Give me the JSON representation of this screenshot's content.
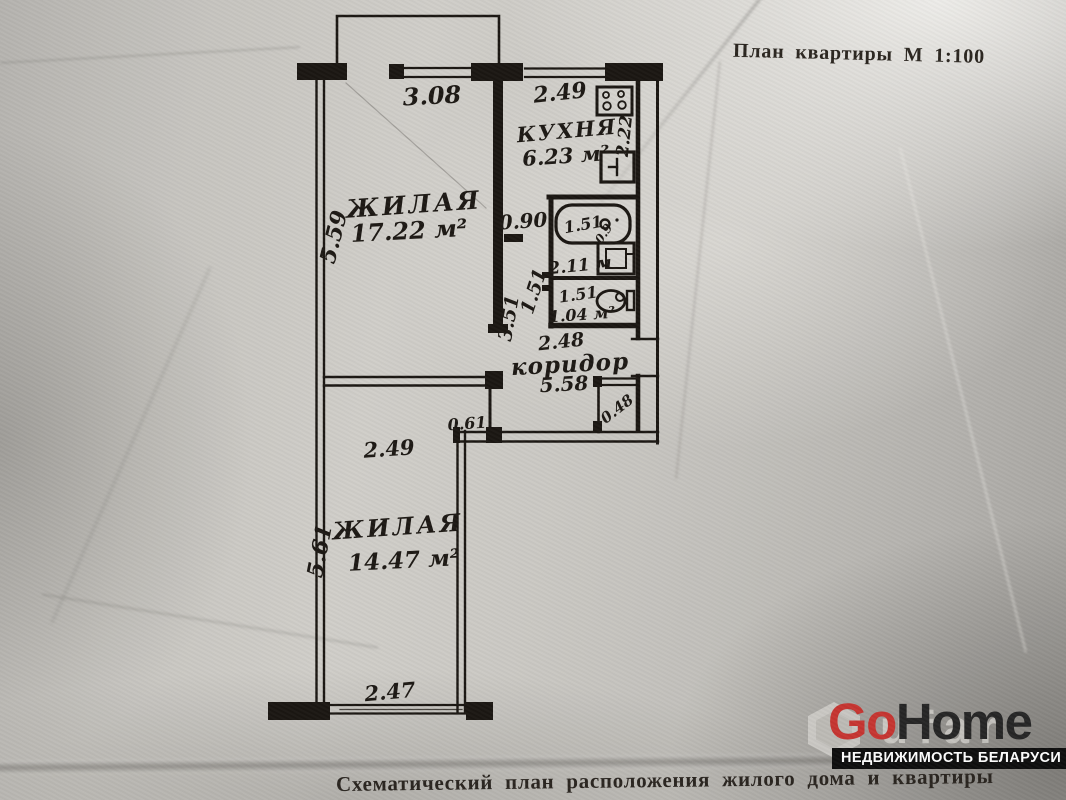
{
  "page": {
    "title": "План квартиры М 1:100",
    "caption": "Схематический план расположения жилого дома и квартиры"
  },
  "branding": {
    "logo_go": "Go",
    "logo_home": "Home",
    "tagline": "НЕДВИЖИМОСТЬ БЕЛАРУСИ",
    "watermark_ghost": "ufar",
    "logo_red": "#c63531",
    "logo_dark": "#262626"
  },
  "colors": {
    "paper": "#c6c4bf",
    "ink": "#1b1712"
  },
  "plan": {
    "rooms": {
      "living1": {
        "name": "ЖИЛАЯ",
        "area": "17.22 м²"
      },
      "kitchen": {
        "name": "КУХНЯ",
        "area": "6.23 м²"
      },
      "bathroom": {
        "area": "2.11 м"
      },
      "wc": {
        "area": "1.04 м²"
      },
      "corridor": {
        "name": "коридор",
        "area": "5.58"
      },
      "living2": {
        "name": "ЖИЛАЯ",
        "area": "14.47 м²"
      }
    },
    "dims": {
      "living1_width": "3.08",
      "living1_height": "5.59",
      "kitchen_width": "2.49",
      "kitchen_height": "2.22",
      "passage": "0.90",
      "tub_len": "1.51",
      "tub_w": "0.9",
      "wc_width": "1.51",
      "hall_side_a": "3.51",
      "hall_side_b": "1.51",
      "corridor_width": "2.48",
      "closet": "0.48",
      "wall_seg": "0.61",
      "living2_width_top": "2.49",
      "living2_height": "5.61",
      "living2_width_bottom": "2.47"
    }
  }
}
